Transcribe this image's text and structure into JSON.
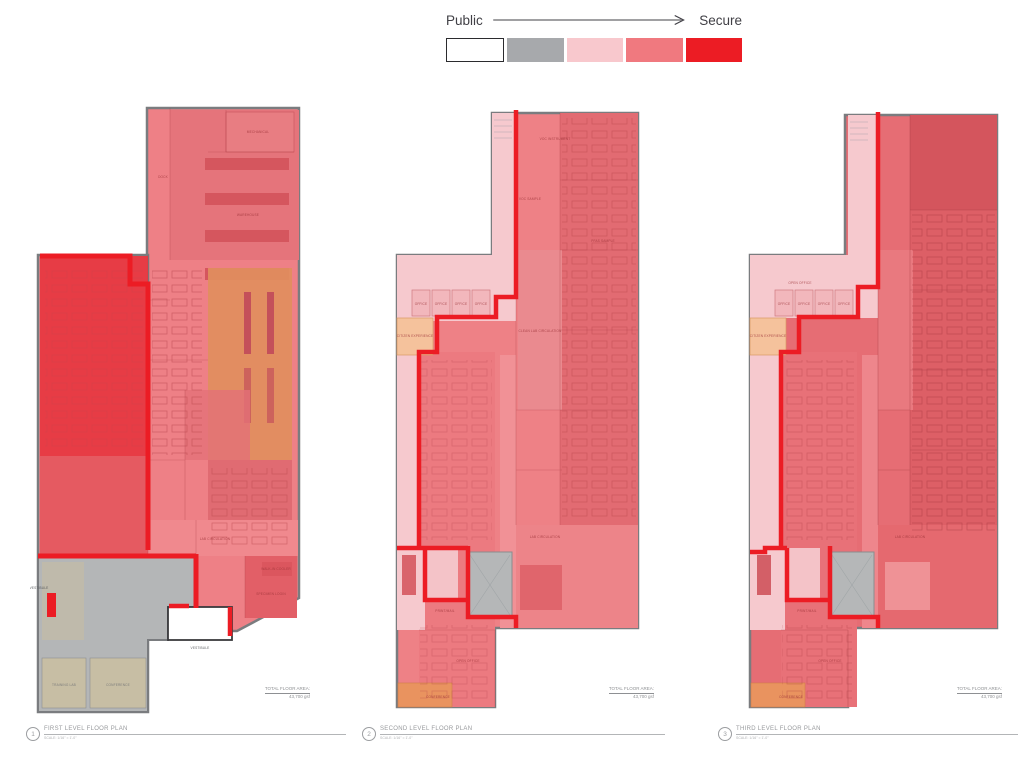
{
  "legend": {
    "public_label": "Public",
    "secure_label": "Secure",
    "swatches": [
      {
        "name": "public-white",
        "color": "#ffffff"
      },
      {
        "name": "semi-public-gray",
        "color": "#a7a9ac"
      },
      {
        "name": "semi-secure-light-pink",
        "color": "#f8c8cd"
      },
      {
        "name": "secure-medium-red",
        "color": "#f0797f"
      },
      {
        "name": "secure-high-red",
        "color": "#ec1c24"
      }
    ]
  },
  "plans": [
    {
      "number": "1",
      "title": "FIRST LEVEL FLOOR PLAN",
      "scale": "SCALE: 1/16\" = 1'-0\"",
      "area_label": "TOTAL FLOOR AREA:",
      "area_value": "43,700 gsf",
      "rooms": [
        {
          "label": "MECHANICAL"
        },
        {
          "label": "DOCK"
        },
        {
          "label": "WAREHOUSE"
        },
        {
          "label": "LAB CIRCULATION"
        },
        {
          "label": "WALK-IN COOLER"
        },
        {
          "label": "SPECIMEN LOGIN"
        },
        {
          "label": "TRAINING LAB"
        },
        {
          "label": "CONFERENCE"
        },
        {
          "label": "VESTIBULE"
        },
        {
          "label": "VESTIBULE"
        }
      ]
    },
    {
      "number": "2",
      "title": "SECOND LEVEL FLOOR PLAN",
      "scale": "SCALE: 1/16\" = 1'-0\"",
      "area_label": "TOTAL FLOOR AREA:",
      "area_value": "43,700 gsf",
      "rooms": [
        {
          "label": "VOC INSTRUMENT"
        },
        {
          "label": "VOC SAMPLE"
        },
        {
          "label": "PFAS SAMPLE"
        },
        {
          "label": "OFFICE"
        },
        {
          "label": "OFFICE"
        },
        {
          "label": "OFFICE"
        },
        {
          "label": "OFFICE"
        },
        {
          "label": "CITIZEN EXPERIENCE"
        },
        {
          "label": "CLEAN LAB CIRCULATION"
        },
        {
          "label": "LAB CIRCULATION"
        },
        {
          "label": "PRINT/MAIL"
        },
        {
          "label": "OPEN OFFICE"
        },
        {
          "label": "CONFERENCE"
        }
      ]
    },
    {
      "number": "3",
      "title": "THIRD LEVEL FLOOR PLAN",
      "scale": "SCALE: 1/16\" = 1'-0\"",
      "area_label": "TOTAL FLOOR AREA:",
      "area_value": "43,700 gsf",
      "rooms": [
        {
          "label": "OPEN OFFICE"
        },
        {
          "label": "OFFICE"
        },
        {
          "label": "OFFICE"
        },
        {
          "label": "OFFICE"
        },
        {
          "label": "OFFICE"
        },
        {
          "label": "CITIZEN EXPERIENCE"
        },
        {
          "label": "LAB CIRCULATION"
        },
        {
          "label": "PRINT/MAIL"
        },
        {
          "label": "OPEN OFFICE"
        },
        {
          "label": "CONFERENCE"
        }
      ]
    }
  ]
}
